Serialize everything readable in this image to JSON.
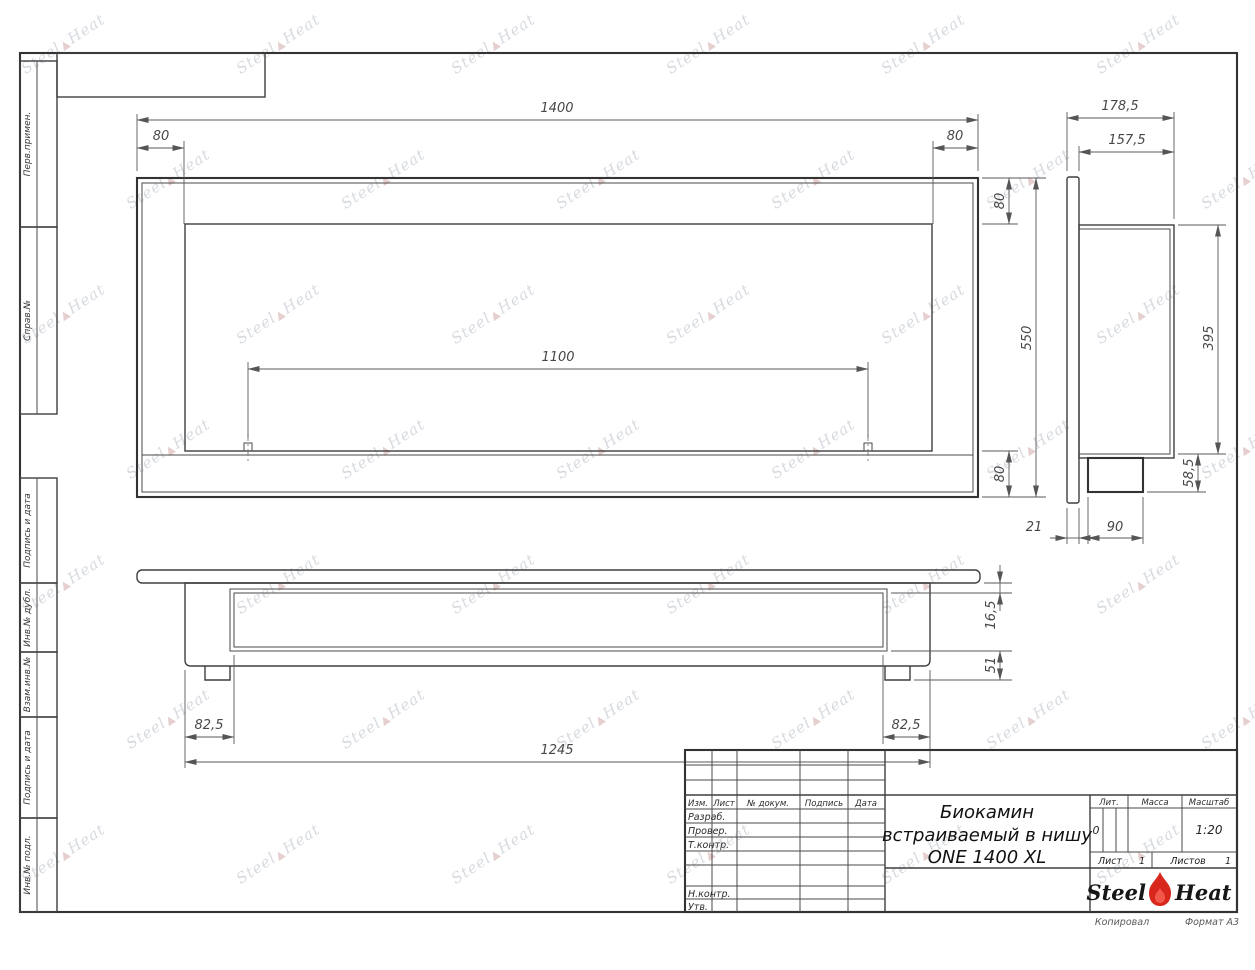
{
  "watermark": {
    "part1": "Steel",
    "part2": "Heat",
    "flame_glyph": "▲"
  },
  "margin_labels": [
    "Перв.примен.",
    "Справ.№",
    "Подпись и дата",
    "Инв.№ дубл.",
    "Взам.инв.№",
    "Подпись и дата",
    "Инв.№ подл."
  ],
  "views": {
    "front": {
      "dims": {
        "total_width": "1400",
        "left_margin": "80",
        "right_margin": "80",
        "opening_width": "1100",
        "top_margin": "80",
        "total_height": "550",
        "bottom_margin": "80"
      }
    },
    "side": {
      "dims": {
        "total_depth": "178,5",
        "inner_depth": "157,5",
        "inner_height": "395",
        "tray_height": "58,5",
        "flange_depth": "21",
        "tray_depth": "90"
      }
    },
    "bottom": {
      "dims": {
        "plate_gap": "16,5",
        "base_height": "51",
        "left_inset": "82,5",
        "right_inset": "82,5",
        "body_width": "1245"
      }
    }
  },
  "title_block": {
    "title_lines": [
      "Биокамин",
      "встраиваемый в нишу",
      "ONE 1400 XL"
    ],
    "col_headers": {
      "izm": "Изм.",
      "list": "Лист",
      "doc": "№ докум.",
      "sign": "Подпись",
      "date": "Дата"
    },
    "row_labels": [
      "Разраб.",
      "Провер.",
      "Т.контр.",
      "Н.контр.",
      "Утв."
    ],
    "right_headers": {
      "lit": "Лит.",
      "mass": "Масса",
      "scale": "Масштаб"
    },
    "values": {
      "lit": "0",
      "scale": "1:20",
      "sheet_label": "Лист",
      "sheet": "1",
      "sheets_label": "Листов",
      "sheets": "1"
    },
    "logo": {
      "part1": "Steel",
      "part2": "Heat"
    },
    "below_frame": {
      "copied": "Копировал",
      "format": "Формат А3"
    }
  },
  "colors": {
    "line": "#3f3f3f",
    "dim_text": "#474747",
    "logo_red": "#d8281e",
    "watermark": "#949eac"
  }
}
